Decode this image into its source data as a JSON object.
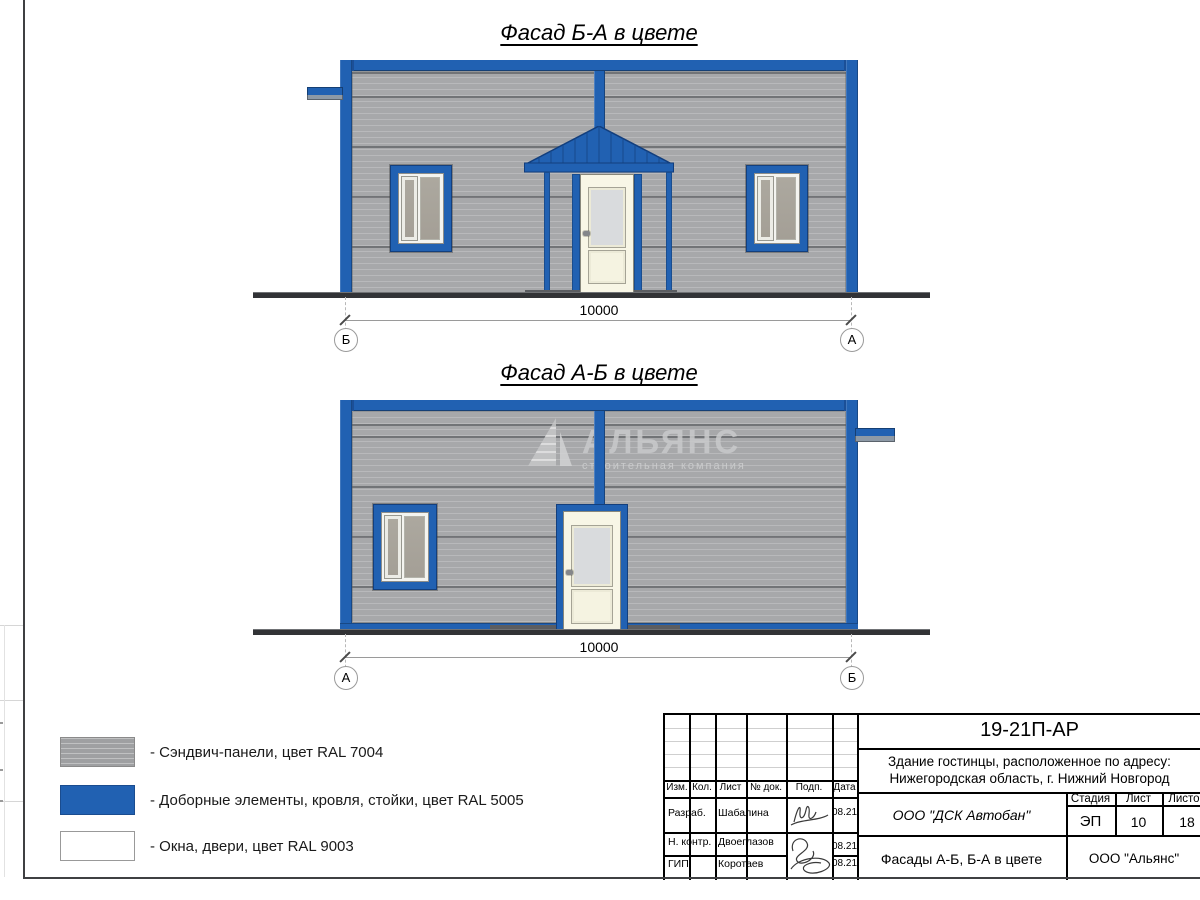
{
  "colors": {
    "ral7004_gray": "#a7a8aa",
    "ral5005_blue": "#2161b2",
    "ral9003_white": "#f7f5e9",
    "ground": "#3a3b3d",
    "watermark_gray": "#c9cacb"
  },
  "facades": {
    "top": {
      "title": "Фасад Б-А в цвете",
      "dim": "10000",
      "marker_left": "Б",
      "marker_right": "А"
    },
    "bottom": {
      "title": "Фасад А-Б в цвете",
      "dim": "10000",
      "marker_left": "А",
      "marker_right": "Б"
    }
  },
  "watermark": {
    "name": "АЛЬЯНС",
    "subtitle": "строительная компания"
  },
  "legend": {
    "items": [
      {
        "swatch": "gray",
        "label": "- Сэндвич-панели, цвет RAL 7004"
      },
      {
        "swatch": "blue",
        "label": "- Доборные элементы, кровля, стойки, цвет RAL 5005"
      },
      {
        "swatch": "white",
        "label": "- Окна, двери, цвет RAL 9003"
      }
    ]
  },
  "titleblock": {
    "doc_code": "19-21П-АР",
    "address_line1": "Здание гостинцы, расположенное по адресу:",
    "address_line2": "Нижегородская область, г. Нижний Новгород",
    "cols": {
      "izm": "Изм.",
      "kol": "Кол.",
      "list": "Лист",
      "ndok": "№ док.",
      "podp": "Подп.",
      "data": "Дата"
    },
    "rows": [
      {
        "role": "Разраб.",
        "name": "Шабалина",
        "date": "08.21"
      },
      {
        "role": "Н. контр.",
        "name": "Двоеглазов",
        "date": "08.21"
      },
      {
        "role": "ГИП",
        "name": "Коротаев",
        "date": "08.21"
      }
    ],
    "company": "ООО \"ДСК Автобан\"",
    "sheet_title": "Фасады А-Б, Б-А в цвете",
    "org": "ООО \"Альянс\"",
    "stage_label": "Стадия",
    "stage": "ЭП",
    "sheet_label": "Лист",
    "sheet": "10",
    "sheets_label": "Листов",
    "sheets": "18"
  }
}
